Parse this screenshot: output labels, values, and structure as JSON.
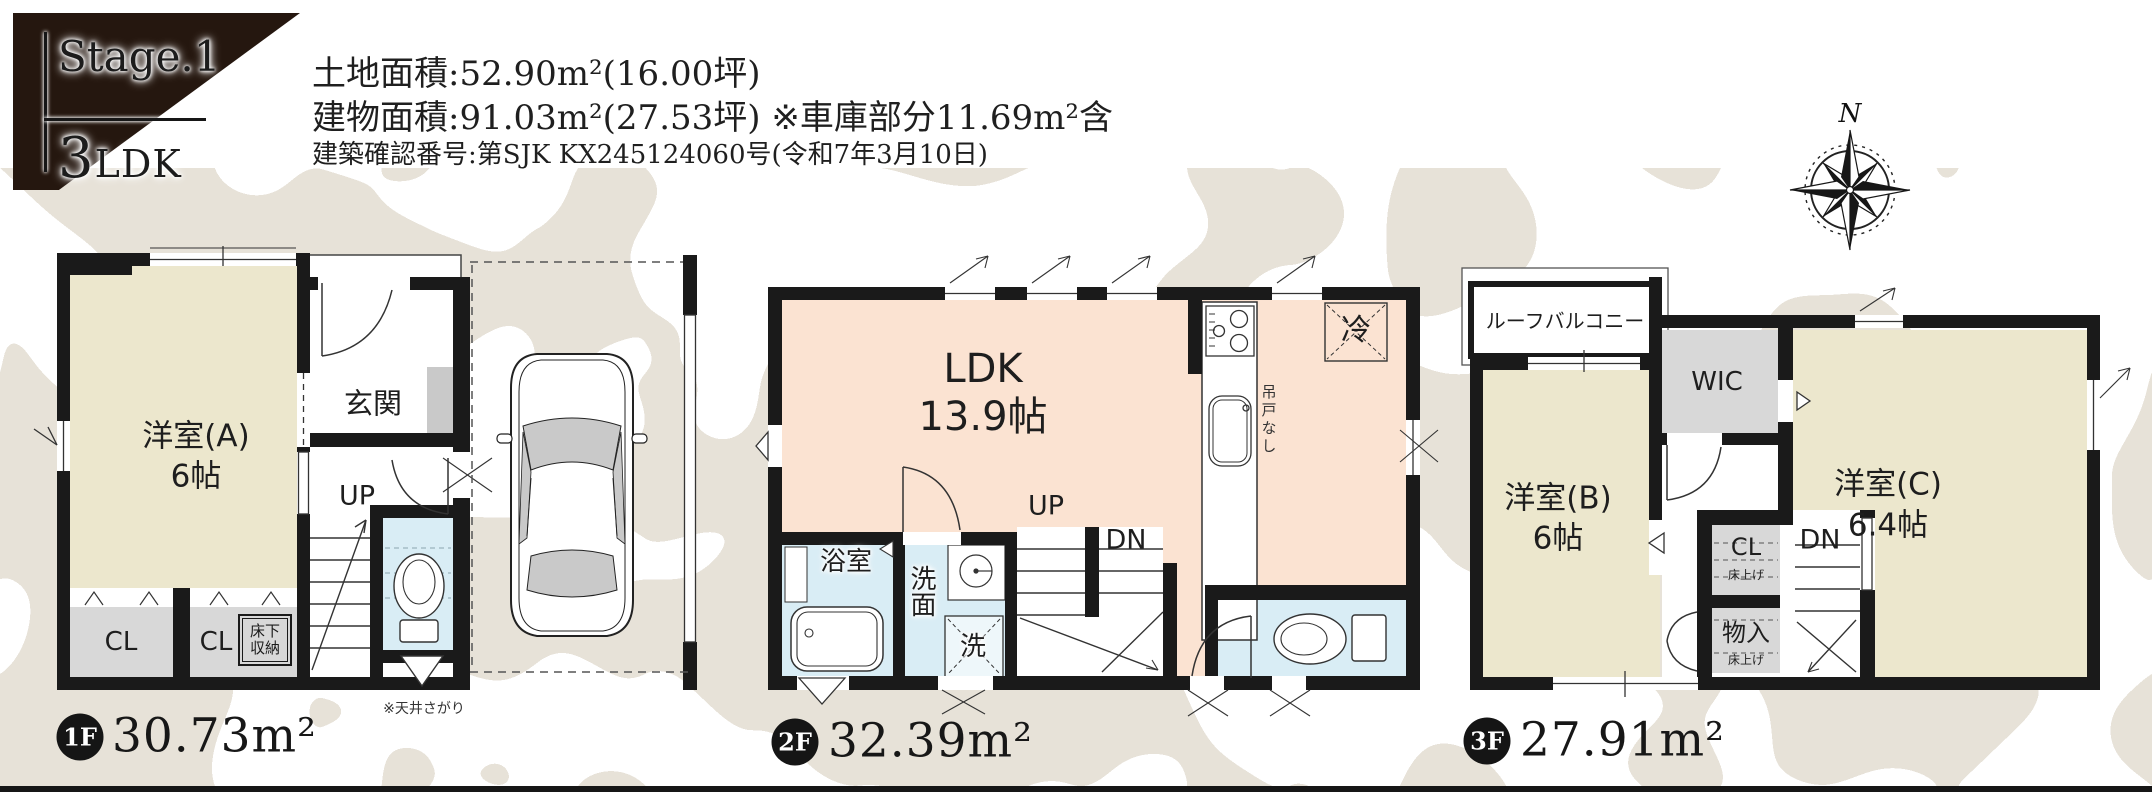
{
  "page": {
    "badge": {
      "stage": "Stage.1",
      "type": "3LDK"
    },
    "header": {
      "land": "土地面積:52.90m²(16.00坪)",
      "building": "建物面積:91.03m²(27.53坪) ※車庫部分11.69m²含",
      "permit": "建築確認番号:第SJK KX245124060号(令和7年3月10日)"
    },
    "compass": {
      "north": "N"
    },
    "colors": {
      "accent_dark": "#25170f",
      "wall": "#1a1a1a",
      "room_cream": "#ece7cd",
      "room_pink": "#fbe3d2",
      "room_blue": "#d9edf5",
      "closet_gray": "#d8d8d8",
      "camo_beige": "#e7e2d8"
    }
  },
  "floors": [
    {
      "id": "1F",
      "area": "30.73m²",
      "labels": {
        "room_a": "洋室(A)",
        "room_a_size": "6帖",
        "genkan": "玄関",
        "up": "UP",
        "cl_1": "CL",
        "cl_2": "CL",
        "underfloor_1": "床下",
        "underfloor_2": "収納",
        "ceiling_note": "※天井さがり"
      }
    },
    {
      "id": "2F",
      "area": "32.39m²",
      "labels": {
        "ldk": "LDK",
        "ldk_size": "13.9帖",
        "bath": "浴室",
        "washroom": "洗面",
        "washer": "洗",
        "up": "UP",
        "dn": "DN",
        "fridge": "冷",
        "no_cupboard": "吊戸なし"
      }
    },
    {
      "id": "3F",
      "area": "27.91m²",
      "labels": {
        "balcony": "ルーフバルコニー",
        "wic": "WIC",
        "room_b": "洋室(B)",
        "room_b_size": "6帖",
        "room_c": "洋室(C)",
        "room_c_size": "6.4帖",
        "cl": "CL",
        "cl_note": "床上げ",
        "storage": "物入",
        "storage_note": "床上げ",
        "dn": "DN"
      }
    }
  ]
}
